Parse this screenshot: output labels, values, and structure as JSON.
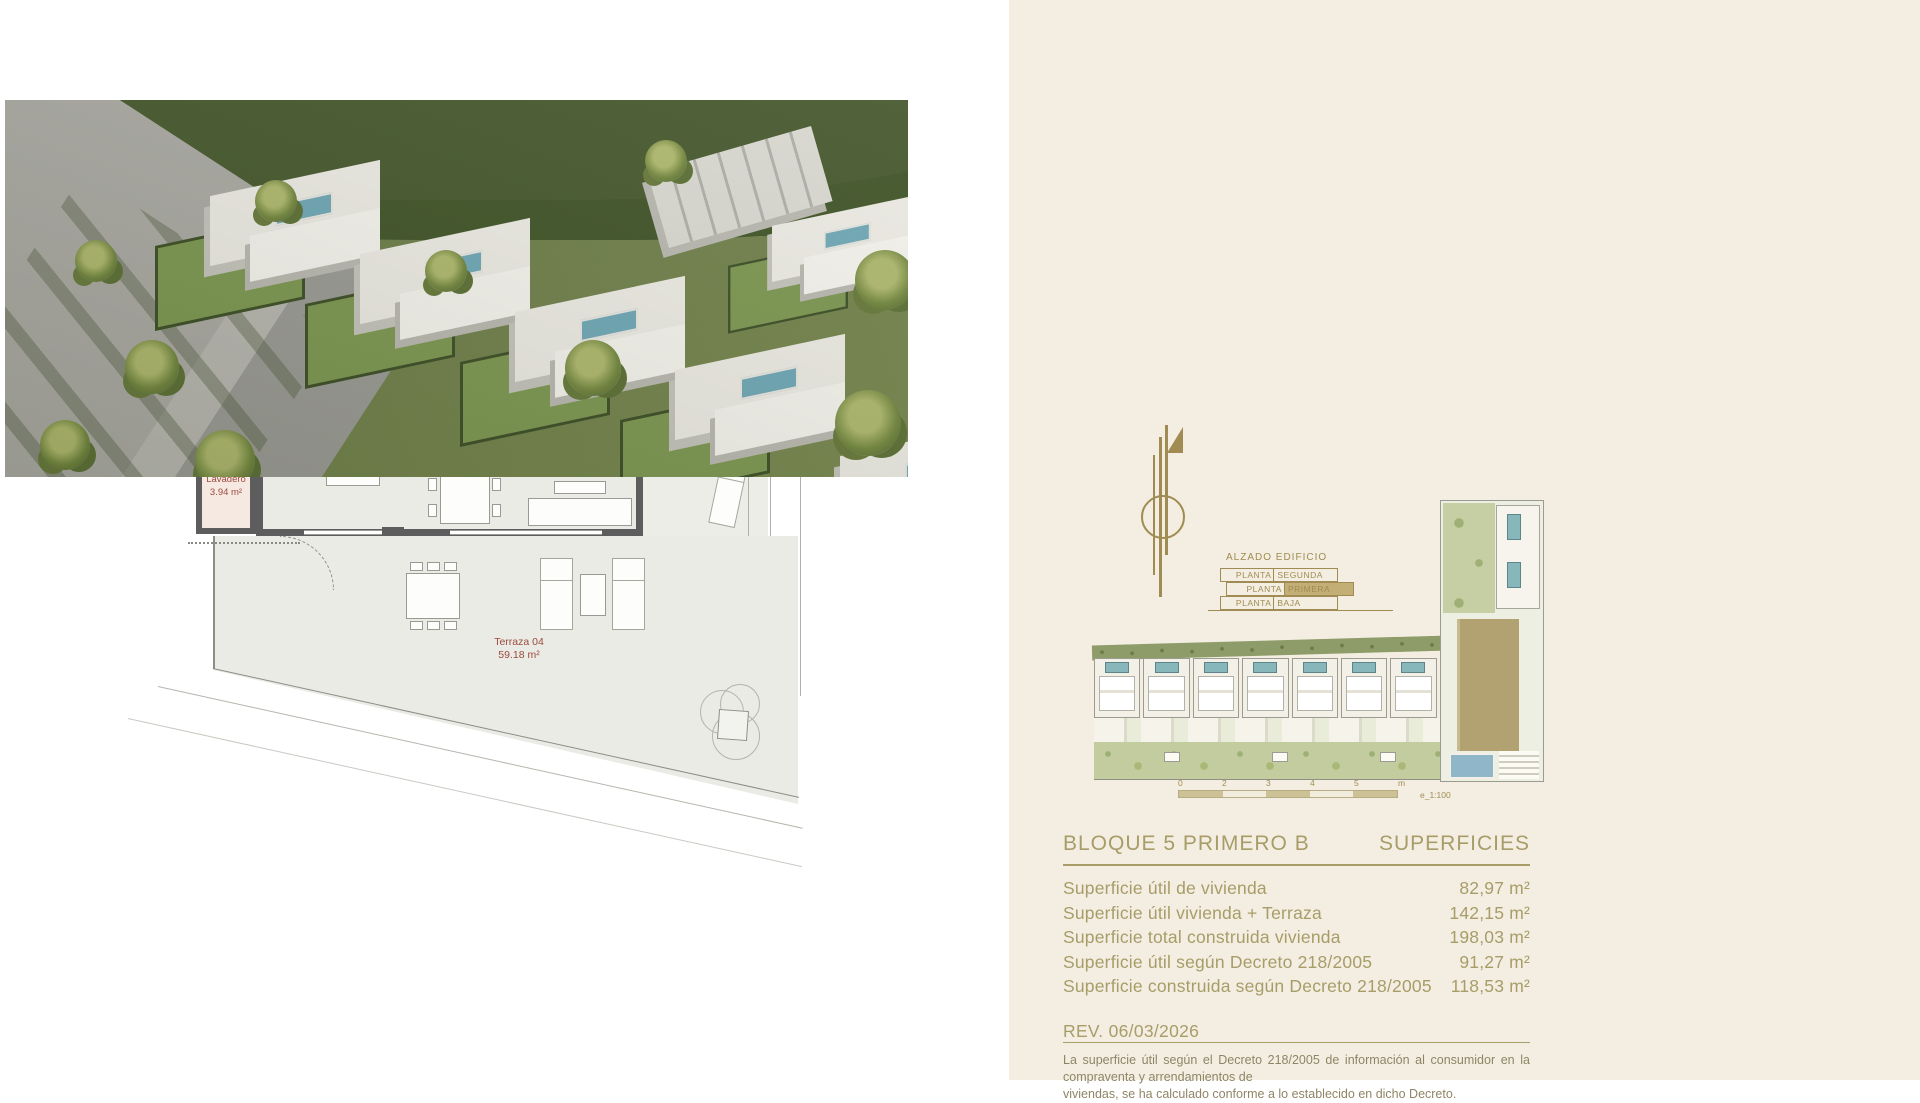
{
  "plan": {
    "rooms": {
      "dormitorio1": {
        "name": "Dormitorio 1",
        "area": "12.14 m²"
      },
      "principal": {
        "name": "Dormitorio Principal",
        "area": "18.44 m²"
      },
      "distribuidor": {
        "name": "Distribuidor",
        "area": "6.54 m²"
      },
      "bano2": {
        "name": "Baño 2",
        "area": "3.91 m²"
      },
      "bano1": {
        "name": "Baño 1",
        "area": "4.06 m²"
      },
      "salon": {
        "name": "Salón-Comedor-Cocina",
        "area": "33.91 m²"
      },
      "lavadero": {
        "name": "Lavadero",
        "area": "3.94 m²"
      },
      "terraza": {
        "name": "Terraza 04",
        "area": "59.18 m²"
      }
    },
    "wheelchair_turning_dim": "1.50",
    "edge_label_top": "dór",
    "edge_label_bottom": "ta",
    "watermark": "Sp"
  },
  "elevation_legend": {
    "title": "ALZADO EDIFICIO",
    "floors": [
      {
        "left": "PLANTA",
        "right": "SEGUNDA",
        "highlighted": false
      },
      {
        "left": "PLANTA",
        "right": "PRIMERA",
        "highlighted": true
      },
      {
        "left": "PLANTA",
        "right": "BAJA",
        "highlighted": false
      }
    ]
  },
  "scale_bar": {
    "labels": [
      "0",
      "2",
      "3",
      "4",
      "5",
      "m"
    ],
    "note": "e_1:100"
  },
  "siteplan": {
    "unit_count": 8
  },
  "summary": {
    "title": "BLOQUE 5 PRIMERO B",
    "header_right": "SUPERFICIES",
    "rows": [
      {
        "label": "Superficie útil de vivienda",
        "value": "82,97 m²"
      },
      {
        "label": "Superficie útil vivienda + Terraza",
        "value": "142,15 m²"
      },
      {
        "label": "Superficie total construida vivienda",
        "value": "198,03 m²"
      },
      {
        "label": "Superficie útil según Decreto 218/2005",
        "value": "91,27 m²"
      },
      {
        "label": "Superficie construida según Decreto 218/2005",
        "value": "118,53 m²"
      }
    ],
    "revision": "REV. 06/03/2026",
    "disclaimer_line1": "La superficie útil según el Decreto 218/2005 de información al consumidor en la compraventa y arrendamientos de",
    "disclaimer_line2": "viviendas, se ha calculado conforme a lo establecido en dicho Decreto."
  },
  "colors": {
    "accent_gold": "#a89c68",
    "label_red": "#9c4b40",
    "wall_gray": "#5d5d5d",
    "panel_cream": "#f3eee1",
    "jacuzzi_teal": "#7fb0b8"
  }
}
